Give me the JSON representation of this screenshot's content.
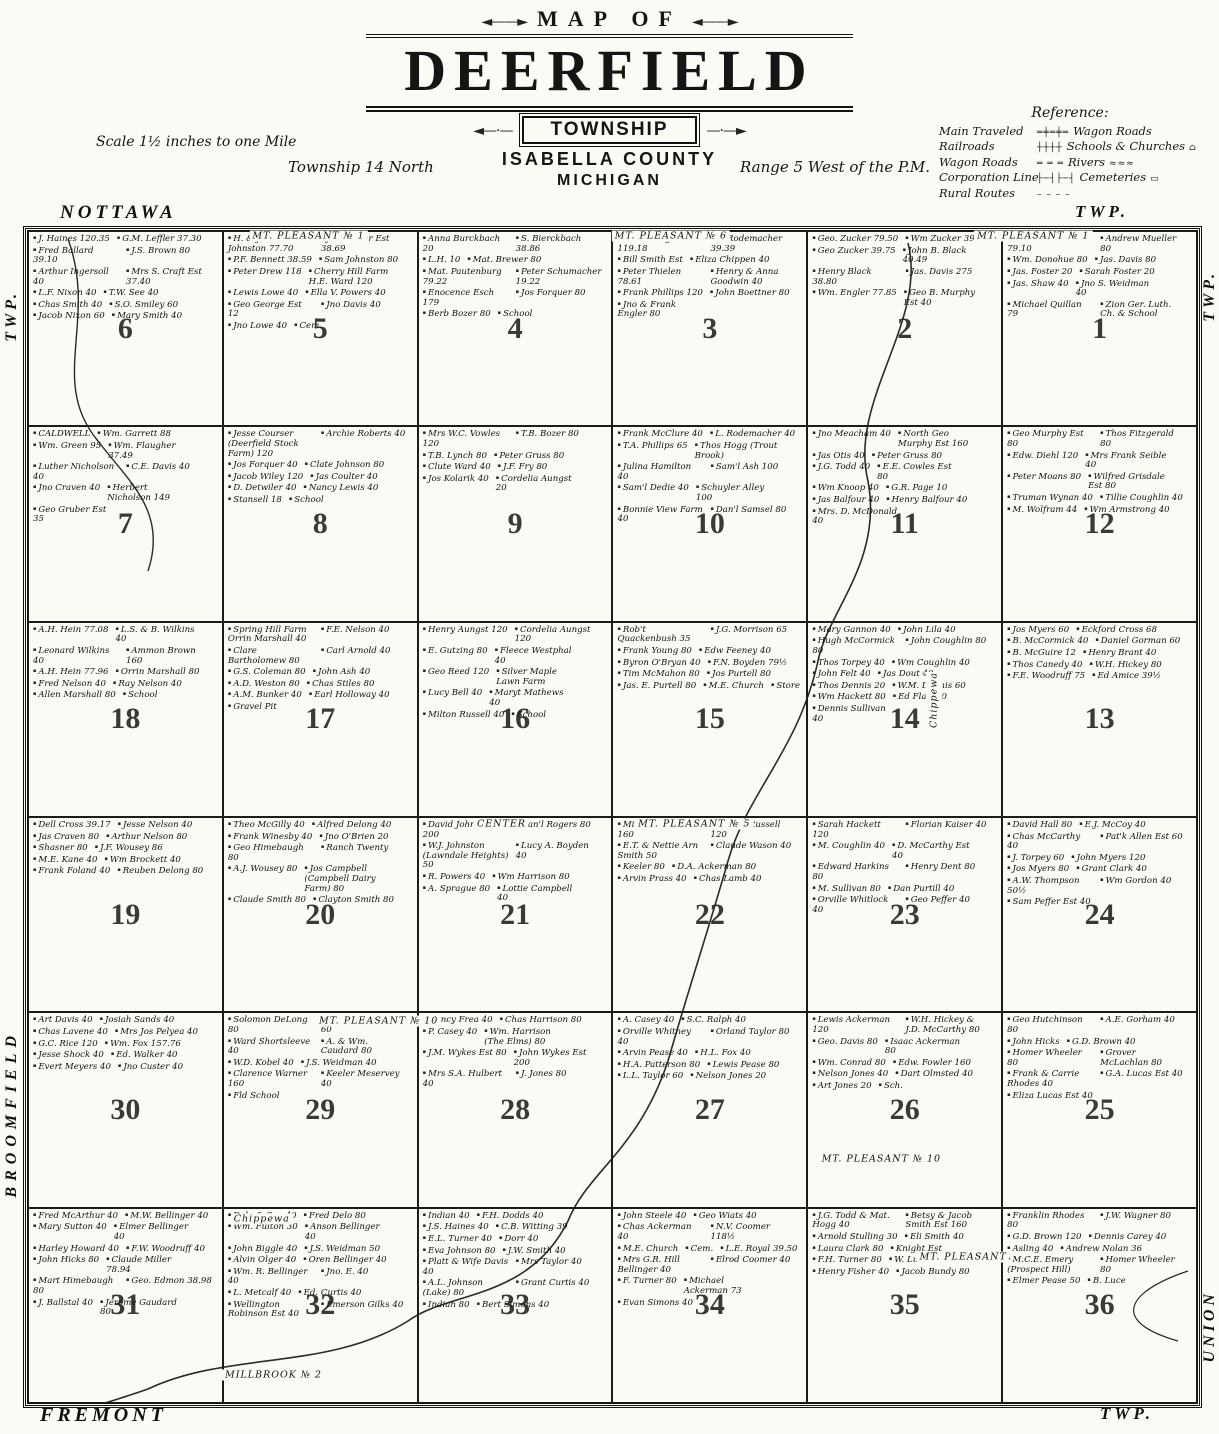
{
  "header": {
    "map_of": "MAP OF",
    "title": "DEERFIELD",
    "subtitle": "TOWNSHIP",
    "county": "ISABELLA COUNTY",
    "state": "MICHIGAN",
    "scale": "Scale 1½ inches to one Mile",
    "township_line": "Township 14 North",
    "range_line": "Range 5 West of the P.M."
  },
  "legend": {
    "title": "Reference:",
    "rows": [
      {
        "left": "Main Traveled",
        "sym": "═╪═╪═",
        "right": "Wagon Roads",
        "sym2": ""
      },
      {
        "left": "Railroads",
        "sym": "┼┼┼┼",
        "right": "Schools & Churches",
        "sym2": "⌂"
      },
      {
        "left": "Wagon Roads",
        "sym": "═ ═ ═",
        "right": "Rivers",
        "sym2": "≈≈≈"
      },
      {
        "left": "Corporation Line",
        "sym": "├─┤├─┤",
        "right": "Cemeteries",
        "sym2": "▭"
      },
      {
        "left": "Rural Routes",
        "sym": "– – – –",
        "right": "",
        "sym2": ""
      }
    ]
  },
  "border_labels": {
    "top_left": "NOTTAWA",
    "top_right": "TWP.",
    "bottom_left": "FREMONT",
    "bottom_right": "TWP.",
    "left_top": "TWP.",
    "left_middle": "BROOMFIELD",
    "right_top": "TWP.",
    "right_bottom": "UNION"
  },
  "map_labels": [
    {
      "text": "MT. PLEASANT № 1",
      "x": 24,
      "y": 0.4
    },
    {
      "text": "MT. PLEASANT № 6",
      "x": 55,
      "y": 0.4
    },
    {
      "text": "MT. PLEASANT № 1",
      "x": 86,
      "y": 0.4
    },
    {
      "text": "CENTER",
      "x": 40.5,
      "y": 50.6
    },
    {
      "text": "MT. PLEASANT № 5",
      "x": 57,
      "y": 50.6
    },
    {
      "text": "MT. PLEASANT № 10",
      "x": 30,
      "y": 67.4
    },
    {
      "text": "MT. PLEASANT № 10",
      "x": 73,
      "y": 79.2
    },
    {
      "text": "MT. PLEASANT",
      "x": 80,
      "y": 87.5
    },
    {
      "text": "MILLBROOK № 2",
      "x": 21,
      "y": 97.6
    },
    {
      "text": "Chippewa",
      "x": 77.5,
      "y": 40,
      "vert": true
    },
    {
      "text": "Chippewa",
      "x": 20,
      "y": 84.3
    }
  ],
  "sections": [
    {
      "number": 6,
      "parcels": [
        "J. Haines 120.35",
        "G.M. Leffler 37.30",
        "Fred Ballard 39.10",
        "J.S. Brown 80",
        "Arthur Ingersoll 40",
        "Mrs S. Craft Est 37.40",
        "L.F. Nixon 40",
        "T.W. See 40",
        "Chas Smith 40",
        "S.O. Smiley 60",
        "Jacob Nixon 60",
        "Mary Smith 40"
      ]
    },
    {
      "number": 5,
      "parcels": [
        "H. & John Johnston 77.70",
        "Jos. Weber Est 38.69",
        "P.F. Bennett 38.59",
        "Sam Johnston 80",
        "Peter Drew 118",
        "Cherry Hill Farm H.E. Ward 120",
        "Lewis Lowe 40",
        "Ella V. Powers 40",
        "Geo George Est 12",
        "Jno Davis 40",
        "Jno Lowe 40",
        "Cem."
      ]
    },
    {
      "number": 4,
      "parcels": [
        "Anna Burckbach 20",
        "S. Bierckbach 38.86",
        "L.H. 10",
        "Mat. Brewer 80",
        "Mat. Pautenburg 79.22",
        "Peter Schumacher 19.22",
        "Enocence Esch 179",
        "Jos Forquer 80",
        "Berb Bozer 80",
        "School"
      ]
    },
    {
      "number": 3,
      "parcels": [
        "Theo Heugesbach 119.18",
        "L. Rodemacher 39.39",
        "Bill Smith Est",
        "Eliza Chippen 40",
        "Peter Thielen 78.61",
        "Henry & Anna Goodwin 40",
        "Frank Phillips 120",
        "John Boettner 80",
        "Jno & Frank Engler 80"
      ]
    },
    {
      "number": 2,
      "parcels": [
        "Geo. Zucker 79.50",
        "Wm Zucker 39.75",
        "Geo Zucker 39.75",
        "John B. Black 40.49",
        "Henry Black 38.80",
        "Jas. Davis 275",
        "Wm. Engler 77.85",
        "Geo B. Murphy Est 40"
      ]
    },
    {
      "number": 1,
      "parcels": [
        "Norman Webber 79.10",
        "Andrew Mueller 80",
        "Wm. Donohue 80",
        "Jas. Davis 80",
        "Jas. Foster 20",
        "Sarah Foster 20",
        "Jas. Shaw 40",
        "Jno S. Weidman 40",
        "Michael Quillan 79",
        "Zion Ger. Luth. Ch. & School"
      ]
    },
    {
      "number": 7,
      "parcels": [
        "CALDWELL",
        "Wm. Garrett 88",
        "Wm. Green 95",
        "Wm. Flaugher 37.49",
        "Luther Nicholson 40",
        "C.E. Davis 40",
        "Jno Craven 40",
        "Herbert Nicholson 149",
        "Geo Gruber Est 35"
      ]
    },
    {
      "number": 8,
      "parcels": [
        "Jesse Courser (Deerfield Stock Farm) 120",
        "Archie Roberts 40",
        "Jos Forquer 40",
        "Clate Johnson 80",
        "Jacob Wiley 120",
        "Jas Coulter 40",
        "D. Detwiler 40",
        "Nancy Lewis 40",
        "Stansell 18",
        "School"
      ]
    },
    {
      "number": 9,
      "parcels": [
        "Mrs W.C. Vowles 120",
        "T.B. Bozer 80",
        "T.B. Lynch 80",
        "Peter Gruss 80",
        "Clute Ward 40",
        "J.F. Fry 80",
        "Jos Kolarik 40",
        "Cordelia Aungst 20"
      ]
    },
    {
      "number": 10,
      "parcels": [
        "Frank McClure 40",
        "L. Rodemacher 40",
        "T.A. Phillips 65",
        "Thos Hogg (Trout Brook)",
        "Julina Hamilton 40",
        "Sam'l Ash 100",
        "Sam'l Dedie 40",
        "Schuyler Alley 100",
        "Bonnie View Farm 40",
        "Dan'l Samsel 80"
      ]
    },
    {
      "number": 11,
      "parcels": [
        "Jno Meacham 40",
        "North Geo Murphy Est 160",
        "Jas Otis 40",
        "Peter Gruss 80",
        "J.G. Todd 40",
        "E.E. Cowles Est 80",
        "Wm Knoop 40",
        "G.R. Page 10",
        "Jas Balfour 40",
        "Henry Balfour 40",
        "Mrs. D. McDonald 40"
      ]
    },
    {
      "number": 12,
      "parcels": [
        "Geo Murphy Est 80",
        "Thos Fitzgerald 80",
        "Edw. Diehl 120",
        "Mrs Frank Seible 40",
        "Peter Moans 80",
        "Wilfred Grisdale Est 80",
        "Truman Wynan 40",
        "Tillie Coughlin 40",
        "M. Wolfram 44",
        "Wm Armstrong 40"
      ]
    },
    {
      "number": 18,
      "parcels": [
        "A.H. Hein 77.08",
        "L.S. & B. Wilkins 40",
        "Leonard Wilkins 40",
        "Ammon Brown 160",
        "A.H. Hein 77.96",
        "Orrin Marshall 80",
        "Fred Nelson 40",
        "Ray Nelson 40",
        "Allen Marshall 80",
        "School"
      ]
    },
    {
      "number": 17,
      "parcels": [
        "Spring Hill Farm Orrin Marshall 40",
        "F.E. Nelson 40",
        "Clare Bartholomew 80",
        "Carl Arnold 40",
        "G.S. Coleman 80",
        "John Ash 40",
        "A.D. Weston 80",
        "Chas Stiles 80",
        "A.M. Bunker 40",
        "Earl Holloway 40",
        "Gravel Pit"
      ]
    },
    {
      "number": 16,
      "parcels": [
        "Henry Aungst 120",
        "Cordelia Aungst 120",
        "E. Gutzing 80",
        "Fleece Westphal 40",
        "Geo Reed 120",
        "Silver Maple Lawn Farm",
        "Lucy Bell 40",
        "Maryt Mathews 40",
        "Milton Russell 40",
        "School"
      ]
    },
    {
      "number": 15,
      "parcels": [
        "Rob't Quackenbush 35",
        "J.G. Morrison 65",
        "Frank Young 80",
        "Edw Feeney 40",
        "Byron O'Bryan 40",
        "F.N. Boyden 79½",
        "Tim McMahon 80",
        "Jos Purtell 80",
        "Jas. E. Purtell 80",
        "M.E. Church",
        "Store"
      ]
    },
    {
      "number": 14,
      "parcels": [
        "Mary Gannon 40",
        "John Lila 40",
        "Hugh McCormick 80",
        "John Coughlin 80",
        "Thos Torpey 40",
        "Wm Coughlin 40",
        "John Felt 40",
        "Jas Dout 40",
        "Thos Dennis 20",
        "W.M. Dennis 60",
        "Wm Hackett 80",
        "Ed Flair 40",
        "Dennis Sullivan 40"
      ]
    },
    {
      "number": 13,
      "parcels": [
        "Jos Myers 60",
        "Eckford Cross 68",
        "B. McCormick 40",
        "Daniel Gorman 60",
        "B. McGuire 12",
        "Henry Brant 40",
        "Thos Canedy 40",
        "W.H. Hickey 80",
        "F.E. Woodruff 75",
        "Ed Amice 39½"
      ]
    },
    {
      "number": 19,
      "parcels": [
        "Dell Cross 39.17",
        "Jesse Nelson 40",
        "Jas Craven 80",
        "Arthur Nelson 80",
        "Shasner 80",
        "J.F. Wousey 86",
        "M.E. Kane 40",
        "Wm Brockett 40",
        "Frank Foland 40",
        "Reuben Delong 80"
      ]
    },
    {
      "number": 20,
      "parcels": [
        "Theo McGilly 40",
        "Alfred Delong 40",
        "Frank Winesby 40",
        "Jno O'Brien 20",
        "Geo Himebaugh 80",
        "Ranch Twenty",
        "A.J. Wousey 80",
        "Jos Campbell (Campbell Dairy Farm) 80",
        "Claude Smith 80",
        "Clayton Smith 80"
      ]
    },
    {
      "number": 21,
      "parcels": [
        "David Johnston 200",
        "Dan'l Rogers 80",
        "W.J. Johnston (Lawndale Heights) 50",
        "Lucy A. Boyden 40",
        "R. Powers 40",
        "Wm Harrison 80",
        "A. Sprague 80",
        "Lottie Campbell 40"
      ]
    },
    {
      "number": 22,
      "parcels": [
        "Milton Russell 160",
        "Wesley Russell 120",
        "E.T. & Nettie Arn Smith 50",
        "Claude Wason 40",
        "Keeler 80",
        "D.A. Ackerman 80",
        "Arvin Prass 40",
        "Chas Lamb 40"
      ]
    },
    {
      "number": 23,
      "parcels": [
        "Sarah Hackett 120",
        "Florian Kaiser 40",
        "M. Coughlin 40",
        "D. McCarthy Est 40",
        "Edward Harkins 80",
        "Henry Dent 80",
        "M. Sullivan 80",
        "Dan Purtill 40",
        "Orville Whitlock 40",
        "Geo Peffer 40"
      ]
    },
    {
      "number": 24,
      "parcels": [
        "David Hall 80",
        "E.J. McCoy 40",
        "Chas McCarthy 40",
        "Pat'k Allen Est 60",
        "J. Torpey 60",
        "John Myers 120",
        "Jos Myers 80",
        "Grant Clark 40",
        "A.W. Thompson 50½",
        "Wm Gordon 40",
        "Sam Peffer Est 40"
      ]
    },
    {
      "number": 30,
      "parcels": [
        "Art Davis 40",
        "Josiah Sands 40",
        "Chas Lavene 40",
        "Mrs Jos Pelyea 40",
        "G.C. Rice 120",
        "Wm. Fox 157.76",
        "Jesse Shock 40",
        "Ed. Walker 40",
        "Evert Meyers 40",
        "Jno Custer 40"
      ]
    },
    {
      "number": 29,
      "parcels": [
        "Solomon DeLong 80",
        "John Crollius Est 60",
        "Ward Shortsleeve 40",
        "A. & Wm. Caudard 80",
        "W.D. Kobel 40",
        "J.S. Weidman 40",
        "Clarence Warner 160",
        "Keeler Meservey 40",
        "Fld School"
      ]
    },
    {
      "number": 28,
      "parcels": [
        "Nancy Frea 40",
        "Chas Harrison 80",
        "P. Casey 40",
        "Wm. Harrison (The Elms) 80",
        "J.M. Wykes Est 80",
        "John Wykes Est 200",
        "Mrs S.A. Hulbert 40",
        "J. Jones 80"
      ]
    },
    {
      "number": 27,
      "parcels": [
        "A. Casey 40",
        "S.C. Ralph 40",
        "Orville Whitney 40",
        "Orland Taylor 80",
        "Arvin Pease 40",
        "H.L. Fox 40",
        "H.A. Patterson 80",
        "Lewis Pease 80",
        "L.L. Taylor 60",
        "Nelson Jones 20"
      ]
    },
    {
      "number": 26,
      "parcels": [
        "Lewis Ackerman 120",
        "W.H. Hickey & J.D. McCarthy 80",
        "Geo. Davis 80",
        "Isaac Ackerman 80",
        "Wm. Conrad 80",
        "Edw. Fowler 160",
        "Nelson Jones 40",
        "Dart Olmsted 40",
        "Art Jones 20",
        "Sch."
      ]
    },
    {
      "number": 25,
      "parcels": [
        "Geo Hutchinson 80",
        "A.E. Gorham 40",
        "John Hicks",
        "G.D. Brown 40",
        "Homer Wheeler 80",
        "Grover McLachlan 80",
        "Frank & Carrie Rhodes 40",
        "G.A. Lucas Est 40",
        "Eliza Lucas Est 40"
      ]
    },
    {
      "number": 31,
      "parcels": [
        "Fred McArthur 40",
        "M.W. Bellinger 40",
        "Mary Sutton 40",
        "Elmer Bellinger 40",
        "Harley Howard 40",
        "F.W. Woodruff 40",
        "John Hicks 80",
        "Claude Miller 78.94",
        "Mart Himebaugh 80",
        "Geo. Edmon 38.98",
        "J. Ballstal 40",
        "Jerome Gaudard 80"
      ]
    },
    {
      "number": 32,
      "parcels": [
        "Delo & Son 40",
        "Fred Delo 80",
        "Wm. Fulton 30",
        "Anson Bellinger 40",
        "John Biggle 40",
        "J.S. Weidman 50",
        "Alvin Olger 40",
        "Oren Bellinger 40",
        "Wm. R. Bellinger 40",
        "Jno. E. 40",
        "L. Metcalf 40",
        "Ed. Curtis 40",
        "Wellington Robinson Est 40",
        "Emerson Gilks 40"
      ]
    },
    {
      "number": 33,
      "parcels": [
        "Indian 40",
        "F.H. Dodds 40",
        "J.S. Haines 40",
        "C.B. Witting 39",
        "E.L. Turner 40",
        "Dorr 40",
        "Eva Johnson 80",
        "J.W. Smith 40",
        "Platt & Wife Davis 40",
        "Mrs Taylor 40",
        "A.L. Johnson (Lake) 80",
        "Grant Curtis 40",
        "Indian 80",
        "Bert Simons 40"
      ]
    },
    {
      "number": 34,
      "parcels": [
        "John Steele 40",
        "Geo Wiats 40",
        "Chas Ackerman 40",
        "N.V. Coomer 118½",
        "M.E. Church",
        "Cem.",
        "L.E. Royal 39.50",
        "Mrs G.R. Hill Bellinger 40",
        "Elrod Coomer 40",
        "F. Turner 80",
        "Michael Ackerman 73",
        "Evan Simons 40"
      ]
    },
    {
      "number": 35,
      "parcels": [
        "J.G. Todd & Mat. Hogg 40",
        "Betsy & Jacob Smith Est 160",
        "Arnold Stulling 30",
        "Eli Smith 40",
        "Laura Clark 80",
        "Knight Est",
        "F.H. Turner 80",
        "W. Luce 40",
        "Henry Fisher 40",
        "Jacob Bundy 80"
      ]
    },
    {
      "number": 36,
      "parcels": [
        "Franklin Rhodes 80",
        "J.W. Wagner 80",
        "G.D. Brown 120",
        "Dennis Carey 40",
        "Asling 40",
        "Andrew Nolan 36",
        "M.C.E. Emery (Prospect Hill)",
        "Homer Wheeler 80",
        "Elmer Pease 50",
        "B. Luce"
      ]
    }
  ]
}
